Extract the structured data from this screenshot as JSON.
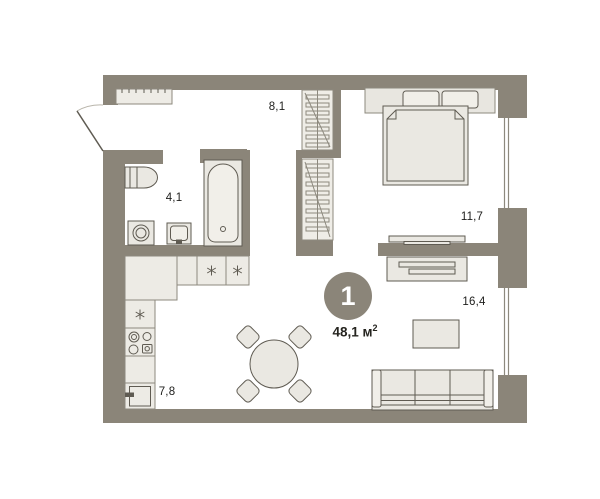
{
  "plan": {
    "unit_badge": {
      "number": "1",
      "area_value": "48,1 м",
      "area_sup": "2"
    },
    "rooms": [
      {
        "name": "hallway",
        "area": "8,1"
      },
      {
        "name": "bathroom",
        "area": "4,1"
      },
      {
        "name": "bedroom",
        "area": "11,7"
      },
      {
        "name": "living-room",
        "area": "16,4"
      },
      {
        "name": "kitchen",
        "area": "7,8"
      }
    ],
    "icons": {
      "appliance_marker": "six-ray-asterisk"
    },
    "colors": {
      "wall": "#8b8579",
      "furniture_fill": "#eae8e2",
      "furniture_light": "#f1efe9",
      "stroke": "#5f5b52",
      "thin_line": "#8d897e",
      "text": "#1d1d1b",
      "background": "#ffffff"
    }
  }
}
